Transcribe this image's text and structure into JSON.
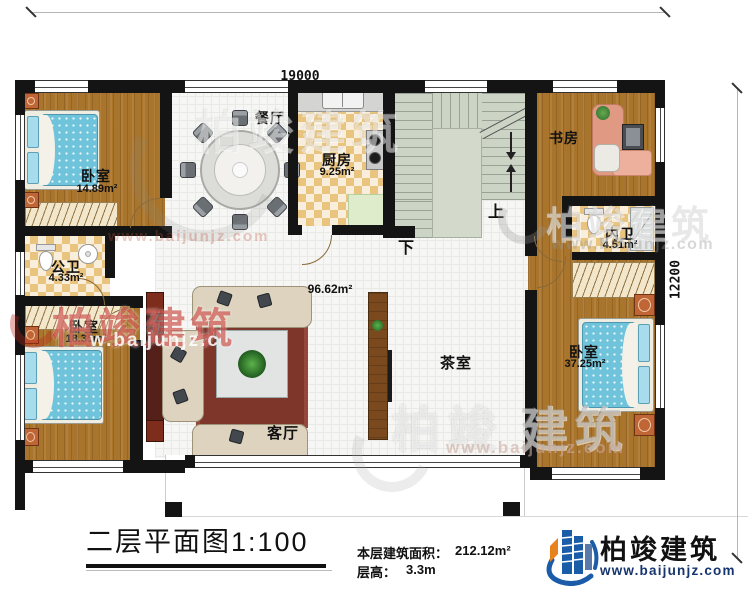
{
  "sheet": {
    "title": "二层平面图1:100",
    "area_label": "本层建筑面积：",
    "area_value": "212.12m²",
    "height_label": "层高：",
    "height_value": "3.3m"
  },
  "dimensions": {
    "width": "19000",
    "height": "12200"
  },
  "rooms": {
    "bedroom_top_left": {
      "name": "卧室",
      "area": "14.89m²"
    },
    "public_bath": {
      "name": "公卫",
      "area": "4.33m²"
    },
    "bedroom_bottom_left": {
      "name": "卧室",
      "area": "18.35m²"
    },
    "dining": {
      "name": "餐厅"
    },
    "kitchen": {
      "name": "厨房",
      "area": "9.25m²"
    },
    "study": {
      "name": "书房"
    },
    "master_bath": {
      "name": "内卫",
      "area": "4.51m²"
    },
    "bedroom_right": {
      "name": "卧室",
      "area": "37.25m²"
    },
    "living": {
      "name": "客厅"
    },
    "tea_room": {
      "name": "茶室"
    },
    "hall_area": "96.62m²"
  },
  "stairs": {
    "up": "上",
    "down": "下"
  },
  "brand": {
    "name": "柏竣建筑",
    "site": "www.baijunjz.com"
  },
  "watermarks": {
    "name": "柏竣建筑",
    "name_part1": "柏竣",
    "name_part2": "建筑",
    "site": "www.baijunjz.com",
    "site_fragment": "w.baijunjz.c"
  },
  "colors": {
    "wall": "#141414",
    "brand_blue": "#1b5ca8",
    "brand_orange": "#e8821e",
    "watermark_red": "#c03024",
    "wood": "#a9752d",
    "stair": "#ccd4c6"
  }
}
